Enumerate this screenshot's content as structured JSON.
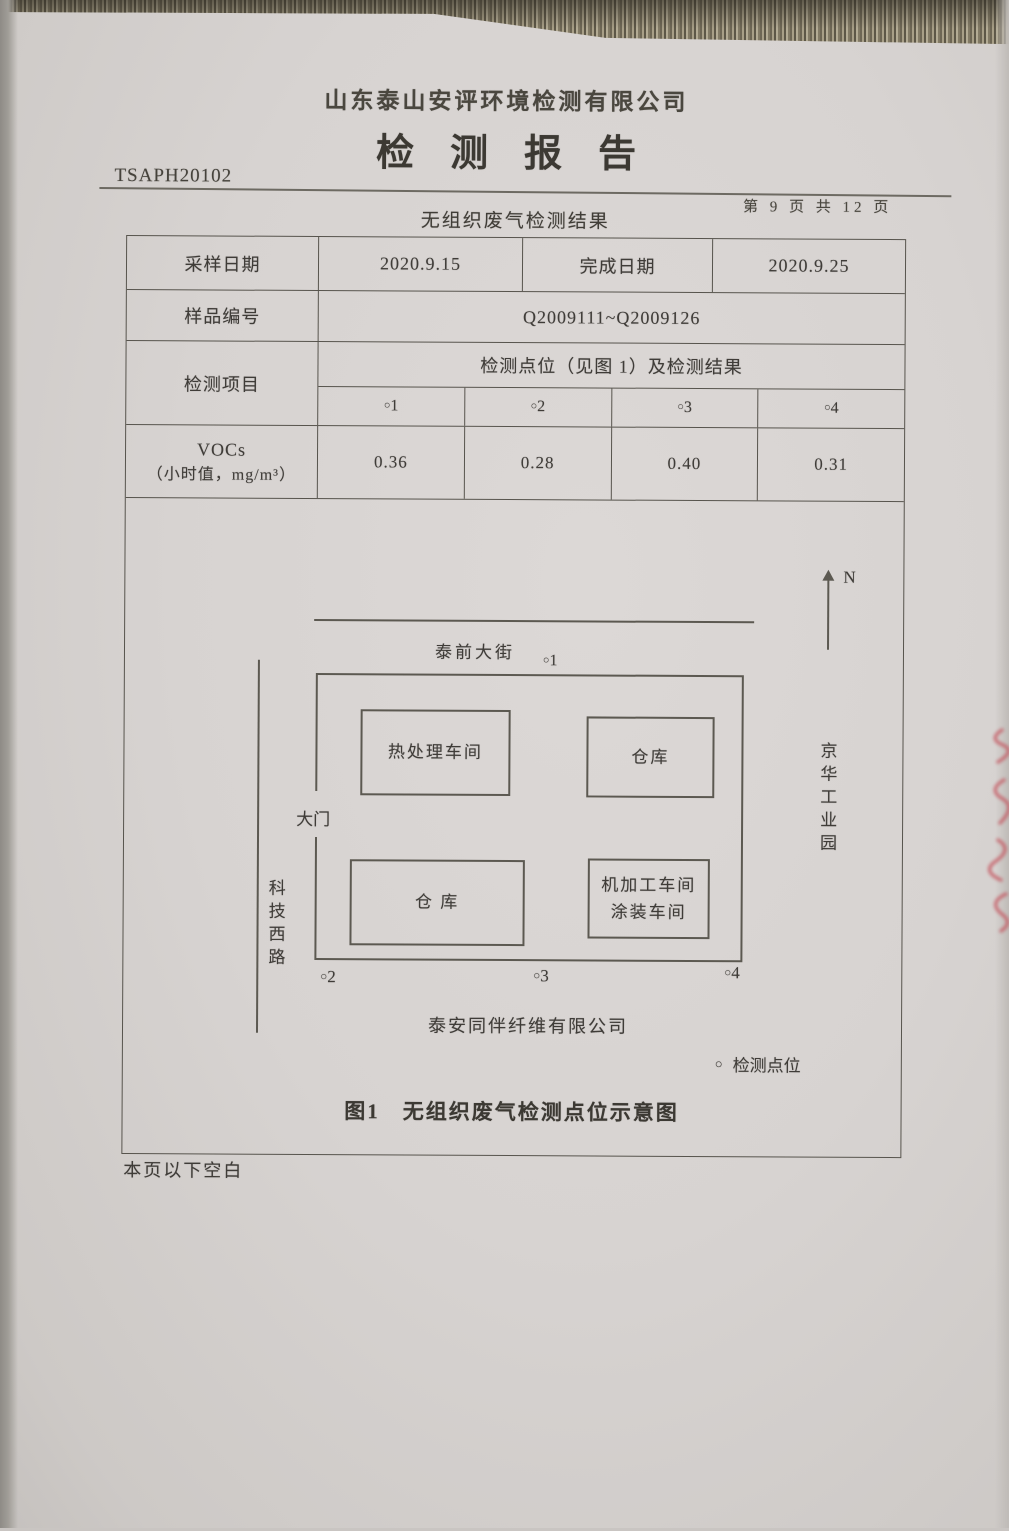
{
  "report": {
    "company_name": "山东泰山安评环境检测有限公司",
    "title": "检测报告",
    "doc_number": "TSAPH20102",
    "page_indicator": "第 9 页 共 12 页",
    "section_title": "无组织废气检测结果",
    "below_blank_note": "本页以下空白"
  },
  "table": {
    "sampling_date_label": "采样日期",
    "sampling_date_value": "2020.9.15",
    "completion_date_label": "完成日期",
    "completion_date_value": "2020.9.25",
    "sample_id_label": "样品编号",
    "sample_id_value": "Q2009111~Q2009126",
    "test_item_label": "检测项目",
    "result_header": "检测点位（见图 1）及检测结果",
    "point_headers": [
      "○1",
      "○2",
      "○3",
      "○4"
    ],
    "voc_name": "VOCs",
    "voc_unit": "（小时值，mg/m³）",
    "voc_values": [
      "0.36",
      "0.28",
      "0.40",
      "0.31"
    ]
  },
  "diagram": {
    "north_label": "N",
    "top_street": "泰前大街",
    "point_1": "○1",
    "gate_label": "大门",
    "left_road": "科技西路",
    "right_area": "京华工业园",
    "building_heat_treatment": "热处理车间",
    "building_warehouse_top": "仓库",
    "building_warehouse_bottom": "仓 库",
    "building_machining": "机加工车间",
    "building_painting": "涂装车间",
    "point_2": "○2",
    "point_3": "○3",
    "point_4": "○4",
    "site_company": "泰安同伴纤维有限公司",
    "legend_marker": "○",
    "legend_label": "检测点位",
    "caption": "图1　无组织废气检测点位示意图"
  }
}
